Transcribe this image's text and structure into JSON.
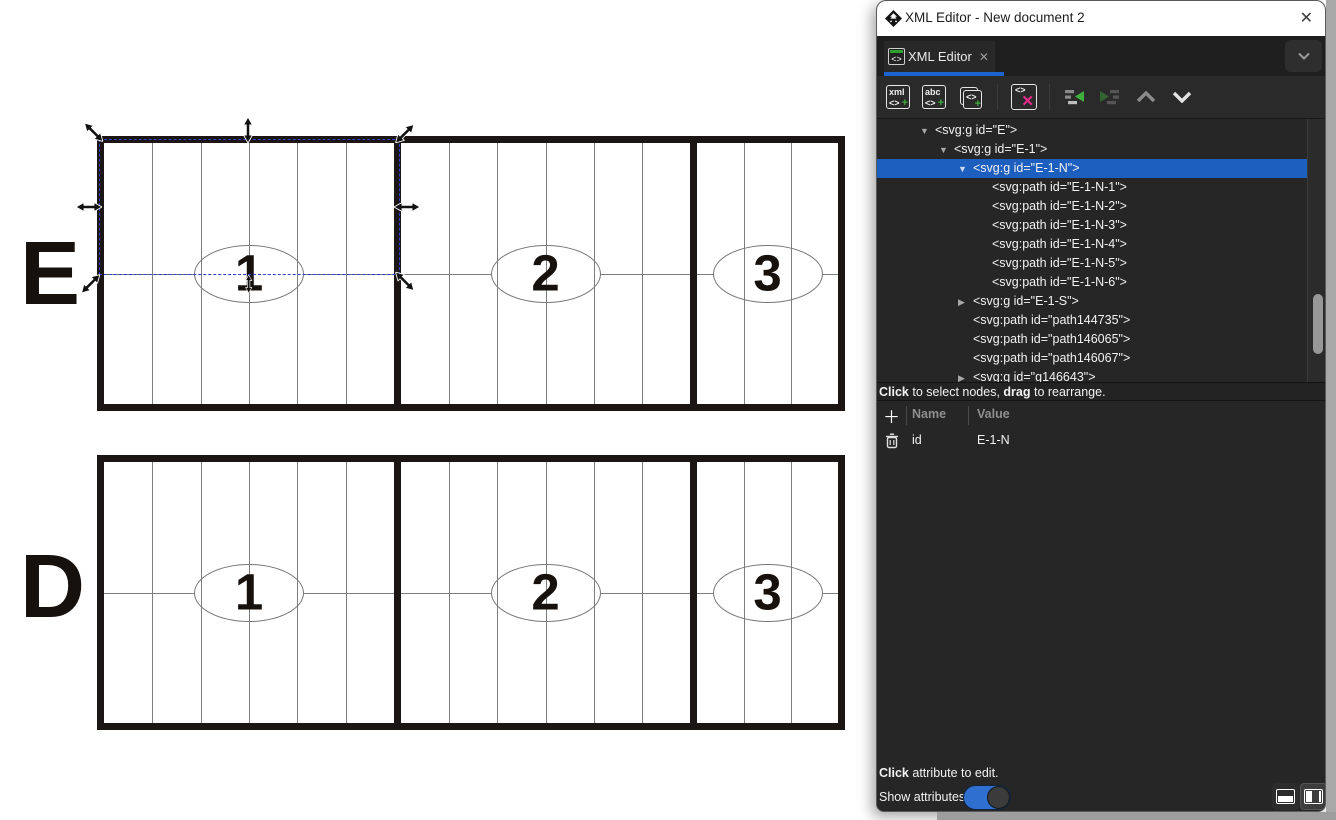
{
  "colors": {
    "selection_blue": "#1d5fbf",
    "tab_underline_blue": "#1b63cf",
    "toggle_blue": "#2e6fd0",
    "delete_pink": "#ea2b8d",
    "node_green": "#3fae3f",
    "canvas_dash_blue": "#2f3fd1"
  },
  "window": {
    "title": "XML Editor - New document 2",
    "close_glyph": "✕"
  },
  "tab": {
    "label": "XML Editor",
    "close_glyph": "✕",
    "icon_glyph": "<>",
    "overflow_icon": "chevron-down"
  },
  "toolbar": {
    "buttons": [
      {
        "name": "new-element-node",
        "line1": "xml",
        "line2": "<>",
        "plus": "+"
      },
      {
        "name": "new-text-node",
        "line1": "abc",
        "line2": "<>",
        "plus": "+"
      },
      {
        "name": "duplicate-node",
        "glyph": "<>",
        "plus": "+"
      },
      {
        "name": "delete-node",
        "glyph": "<>",
        "x": "✕"
      },
      {
        "name": "unindent-node"
      },
      {
        "name": "indent-node"
      },
      {
        "name": "move-node-up"
      },
      {
        "name": "move-node-down"
      }
    ]
  },
  "tree": {
    "rows": [
      {
        "label": "<svg:g id=\"E\">",
        "level": 1,
        "expander": "open",
        "selected": false
      },
      {
        "label": "<svg:g id=\"E-1\">",
        "level": 2,
        "expander": "open",
        "selected": false
      },
      {
        "label": "<svg:g id=\"E-1-N\">",
        "level": 3,
        "expander": "open",
        "selected": true
      },
      {
        "label": "<svg:path id=\"E-1-N-1\">",
        "level": 4,
        "expander": "none",
        "selected": false
      },
      {
        "label": "<svg:path id=\"E-1-N-2\">",
        "level": 4,
        "expander": "none",
        "selected": false
      },
      {
        "label": "<svg:path id=\"E-1-N-3\">",
        "level": 4,
        "expander": "none",
        "selected": false
      },
      {
        "label": "<svg:path id=\"E-1-N-4\">",
        "level": 4,
        "expander": "none",
        "selected": false
      },
      {
        "label": "<svg:path id=\"E-1-N-5\">",
        "level": 4,
        "expander": "none",
        "selected": false
      },
      {
        "label": "<svg:path id=\"E-1-N-6\">",
        "level": 4,
        "expander": "none",
        "selected": false
      },
      {
        "label": "<svg:g id=\"E-1-S\">",
        "level": 3,
        "expander": "closed",
        "selected": false
      },
      {
        "label": "<svg:path id=\"path144735\">",
        "level": 3,
        "expander": "none",
        "selected": false
      },
      {
        "label": "<svg:path id=\"path146065\">",
        "level": 3,
        "expander": "none",
        "selected": false
      },
      {
        "label": "<svg:path id=\"path146067\">",
        "level": 3,
        "expander": "none",
        "selected": false
      },
      {
        "label": "<svg:g id=\"g146643\">",
        "level": 3,
        "expander": "closed",
        "selected": false
      }
    ]
  },
  "tree_hint": {
    "parts": [
      {
        "t": "Click",
        "b": true
      },
      {
        "t": " to select nodes, ",
        "b": false
      },
      {
        "t": "drag",
        "b": true
      },
      {
        "t": " to rearrange.",
        "b": false
      }
    ]
  },
  "attributes": {
    "add_glyph": "＋",
    "name_header": "Name",
    "value_header": "Value",
    "rows": [
      {
        "name": "id",
        "value": "E-1-N"
      }
    ]
  },
  "footer": {
    "hint_parts": [
      {
        "t": "Click",
        "b": true
      },
      {
        "t": " attribute to edit.",
        "b": false
      }
    ],
    "toggle_label": "Show attributes",
    "toggle_on": true,
    "layout_buttons": [
      "layout-horizontal-panel",
      "layout-vertical-panel"
    ]
  },
  "canvas": {
    "rows": [
      {
        "label": "E",
        "numbers": [
          "1",
          "2",
          "3"
        ],
        "selected_section": 1
      },
      {
        "label": "D",
        "numbers": [
          "1",
          "2",
          "3"
        ],
        "selected_section": 0
      }
    ]
  }
}
